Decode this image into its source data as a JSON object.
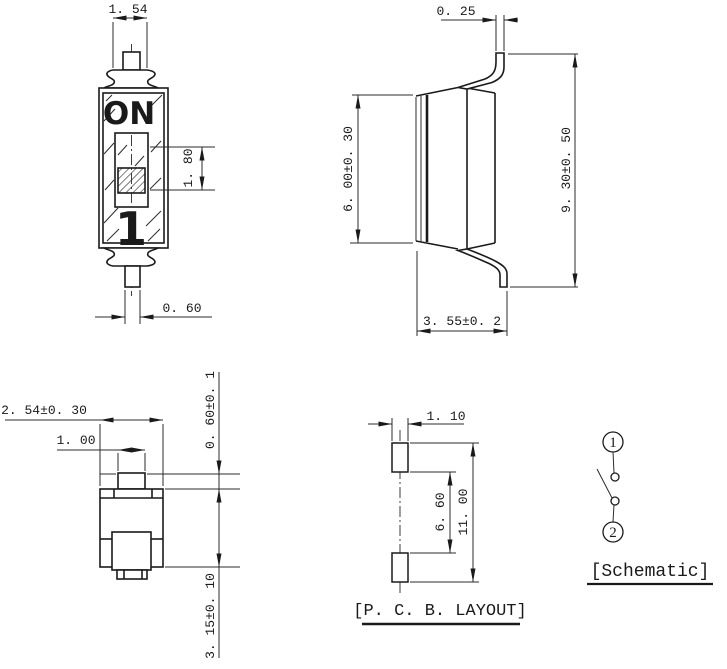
{
  "drawing": {
    "component": "single position SMD DIP switch dimensional drawing",
    "colors": {
      "line": "#1a1a1a",
      "background": "#ffffff"
    },
    "front_view": {
      "marking_on": "ON",
      "marking_position": "1",
      "dims": {
        "lead_width": "1. 54",
        "actuator_height": "1. 80",
        "terminal_width": "0. 60"
      }
    },
    "side_view": {
      "dims": {
        "lead_thickness": "0. 25",
        "body_height": "6. 00±0. 30",
        "overall_height": "9. 30±0. 50",
        "overall_depth": "3. 55±0. 2"
      }
    },
    "end_view": {
      "dims": {
        "body_width": "2. 54±0. 30",
        "actuator_width": "1. 00",
        "actuator_protrusion": "0. 60±0. 1",
        "body_depth": "3. 15±0. 10"
      }
    },
    "pcb_layout": {
      "title": "[P. C. B. LAYOUT]",
      "dims": {
        "pad_width": "1. 10",
        "pad_inner_span": "6. 60",
        "pad_outer_span": "11. 00"
      }
    },
    "schematic": {
      "title": "[Schematic]",
      "pin1": "1",
      "pin2": "2"
    }
  }
}
